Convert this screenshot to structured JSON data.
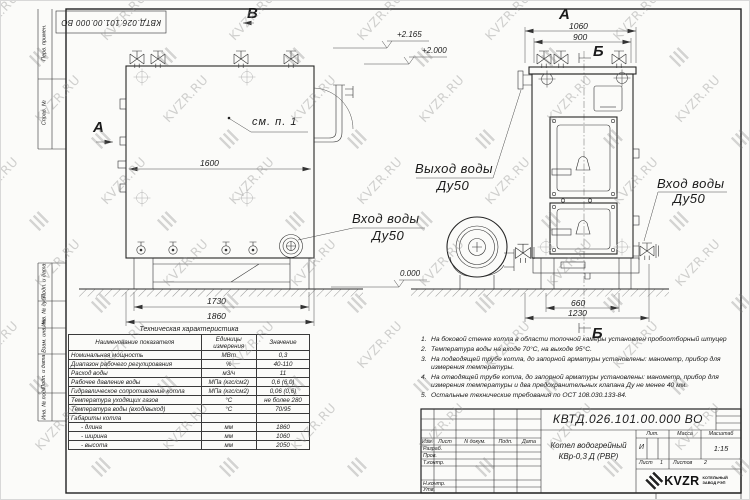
{
  "watermark": {
    "text": "KVZR.RU"
  },
  "stamp": {
    "doc_number": "КВТД.026.101.00.000 ВО"
  },
  "frame": {
    "columns": [
      {
        "label": "Перв. примен."
      },
      {
        "label": "Справ. №"
      },
      {
        "label": "Подп. и дата"
      },
      {
        "label": "Инв. № дубл."
      },
      {
        "label": "Взам. инв. №"
      },
      {
        "label": "Подп. и дата"
      },
      {
        "label": "Инв. № подл."
      }
    ]
  },
  "drawing": {
    "view_b": "В",
    "section_a": "А",
    "see_note": "см. п. 1",
    "front": {
      "dim_width": "1600",
      "dim_support": "1730",
      "dim_length": "1860"
    },
    "elevations": {
      "valve_top": "+2.165",
      "boiler_top": "+2.000",
      "ground": "0.000"
    },
    "outlet": {
      "line1": "Выход воды",
      "line2": "Ду50"
    },
    "inlet_front": {
      "line1": "Вход воды",
      "line2": "Ду50"
    },
    "inlet_side": {
      "line1": "Вход воды",
      "line2": "Ду50"
    },
    "side": {
      "view": "А",
      "section_top": "Б",
      "section_bottom": "Б",
      "dim_depth": "1060",
      "dim_inner": "900",
      "dim_leg_span": "660",
      "dim_base": "1230"
    }
  },
  "spec_table": {
    "title": "Техническая характеристика",
    "headers": [
      "Наименование показателя",
      "Единицы измерения",
      "Значение"
    ],
    "rows": [
      {
        "name": "Номинальная мощность",
        "unit": "МВт",
        "value": "0,3"
      },
      {
        "name": "Диапазон рабочего регулирования",
        "unit": "%",
        "value": "40-110"
      },
      {
        "name": "Расход воды",
        "unit": "м3/ч",
        "value": "11"
      },
      {
        "name": "Рабочее давление воды",
        "unit": "МПа (кгс/см2)",
        "value": "0,6 (6,0)"
      },
      {
        "name": "Гидравлическое сопротивление котла",
        "unit": "МПа (кгс/см2)",
        "value": "0,06 (0,6)"
      },
      {
        "name": "Температура уходящих газов",
        "unit": "°С",
        "value": "не более 280"
      },
      {
        "name": "Температура воды (вход/выход)",
        "unit": "°С",
        "value": "70/95"
      },
      {
        "name": "Габариты котла",
        "unit": "",
        "value": ""
      },
      {
        "name": "- длина",
        "unit": "мм",
        "value": "1860"
      },
      {
        "name": "- ширина",
        "unit": "мм",
        "value": "1060"
      },
      {
        "name": "- высота",
        "unit": "мм",
        "value": "2050"
      }
    ]
  },
  "notes": [
    {
      "num": "1.",
      "text": "На боковой стенке котла в области топочной камеры установлен пробоотборный штуцер"
    },
    {
      "num": "2.",
      "text": "Температура воды на входе 70°С, на выходе 95°С."
    },
    {
      "num": "3.",
      "text": "На подводящей трубе котла, до запорной арматуры установлены: манометр, прибор для измерения температуры."
    },
    {
      "num": "4.",
      "text": "На отводящей трубе котла, до запорной арматуры установлены: манометр, прибор для измерения температуры и два предохранительных клапана Ду не менее 40 мм."
    },
    {
      "num": "5.",
      "text": "Остальные технические требования по ОСТ 108.030.133-84."
    }
  ],
  "title_block": {
    "doc_number": "КВТД.026.101.00.000 ВО",
    "header_cells": [
      "Изм.",
      "Лист",
      "N докум.",
      "Подп.",
      "Дата"
    ],
    "row_labels": [
      "Разраб.",
      "Пров.",
      "Т.контр.",
      "Н.контр.",
      "Утв."
    ],
    "product_line1": "Котел водогрейный",
    "product_line2": "КВр-0,3 Д (РВР)",
    "lit_header": "Лит.",
    "mass_header": "Масса",
    "scale_header": "Масштаб",
    "lit_value": "И",
    "scale_value": "1:15",
    "sheet_label": "Лист",
    "sheet_value": "1",
    "sheets_label": "Листов",
    "sheets_value": "2",
    "company": "KVZR",
    "company_sub1": "КОТЕЛЬНЫЙ",
    "company_sub2": "ЗАВОД РЭП",
    "format_label": "Формат",
    "format_value": "А3"
  }
}
